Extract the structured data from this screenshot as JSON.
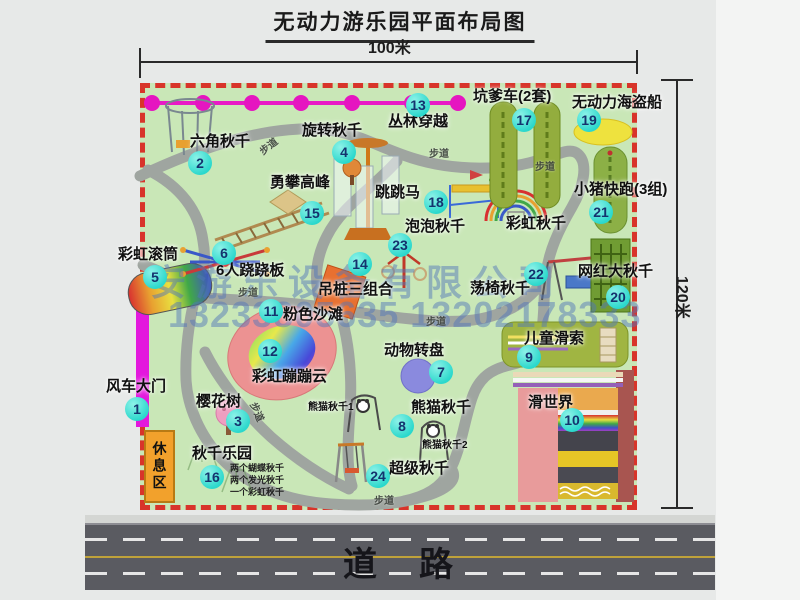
{
  "title": "无动力游乐园平面布局图",
  "dimensions": {
    "width_label": "100米",
    "height_label": "120米"
  },
  "road": {
    "label": "道　路"
  },
  "watermark": {
    "company": "安游乐设备有限公司",
    "phone": "13233805635 13202178333"
  },
  "rest_area": {
    "label": "休息区"
  },
  "path_label": "步道",
  "extra": {
    "rainbow_swing": "彩虹秋千",
    "panda_swing_1": "熊猫秋千1",
    "panda_swing_2": "熊猫秋千2"
  },
  "attractions": [
    {
      "num": "1",
      "label": "风车大门"
    },
    {
      "num": "2",
      "label": "六角秋千"
    },
    {
      "num": "3",
      "label": "樱花树"
    },
    {
      "num": "4",
      "label": "旋转秋千"
    },
    {
      "num": "5",
      "label": "彩虹滚筒"
    },
    {
      "num": "6",
      "label": "6人跷跷板"
    },
    {
      "num": "7",
      "label": "动物转盘"
    },
    {
      "num": "8",
      "label": "熊猫秋千"
    },
    {
      "num": "9",
      "label": "儿童滑索"
    },
    {
      "num": "10",
      "label": "滑世界"
    },
    {
      "num": "11",
      "label": "粉色沙滩"
    },
    {
      "num": "12",
      "label": "彩虹蹦蹦云"
    },
    {
      "num": "13",
      "label": "丛林穿越"
    },
    {
      "num": "14",
      "label": "吊桩三组合"
    },
    {
      "num": "15",
      "label": "勇攀高峰"
    },
    {
      "num": "16",
      "label": "秋千乐园",
      "sub": [
        "两个蝴蝶秋千",
        "两个发光秋千",
        "一个彩虹秋千"
      ]
    },
    {
      "num": "17",
      "label": "坑爹车(2套)"
    },
    {
      "num": "18",
      "label": "跳跳马"
    },
    {
      "num": "19",
      "label": "无动力海盗船"
    },
    {
      "num": "20",
      "label": "网红大秋千"
    },
    {
      "num": "21",
      "label": "小猪快跑(3组)"
    },
    {
      "num": "22",
      "label": "荡椅秋千"
    },
    {
      "num": "23",
      "label": "泡泡秋千"
    },
    {
      "num": "24",
      "label": "超级秋千"
    }
  ],
  "colors": {
    "border_red": "#d8342a",
    "map_green": "#c9e7b7",
    "badge_teal": "#2bd8cc",
    "chain_magenta": "#e81ac6",
    "gate_magenta": "#e318dd",
    "rest_orange": "#f2a12c",
    "road_gray": "#5a5b61",
    "watermark_blue": "#5076b9"
  }
}
